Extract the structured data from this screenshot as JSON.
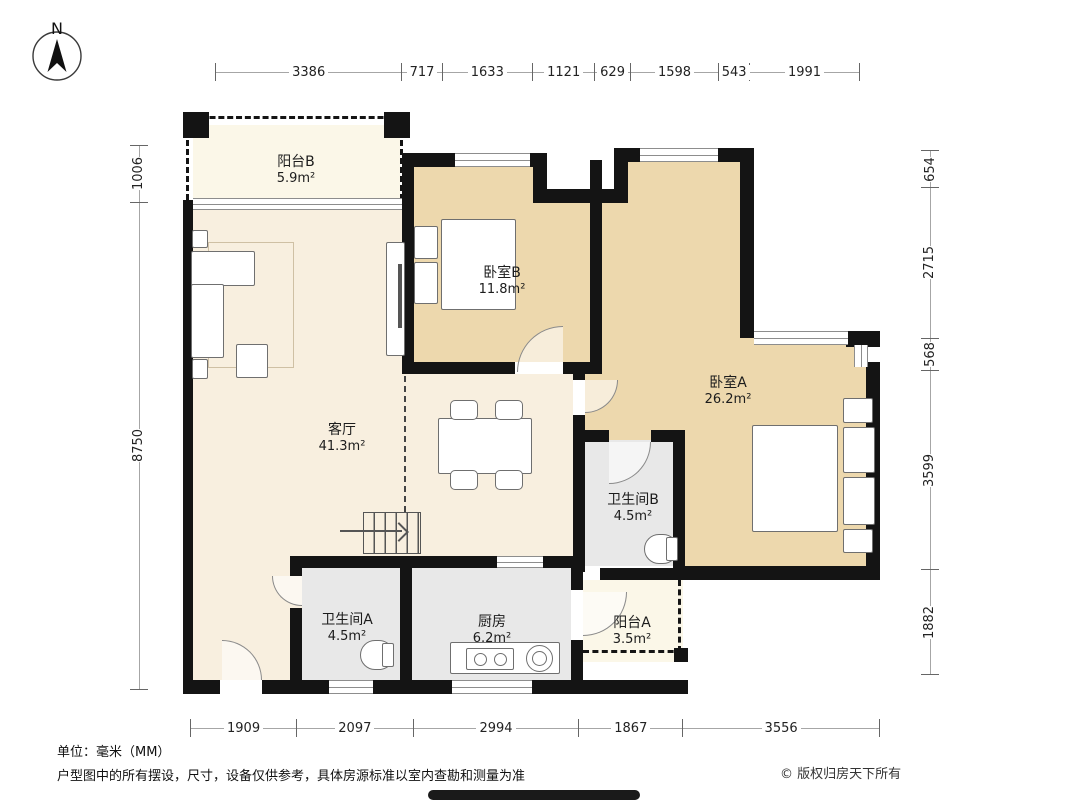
{
  "compass": {
    "label": "N"
  },
  "dimensions": {
    "top": [
      3386,
      717,
      1633,
      1121,
      629,
      1598,
      543,
      1991
    ],
    "bottom": [
      1909,
      2097,
      2994,
      1867,
      3556
    ],
    "left": [
      1006,
      8750
    ],
    "right": [
      654,
      2715,
      568,
      3599,
      1882
    ]
  },
  "rooms": [
    {
      "name": "阳台B",
      "area": "5.9m²"
    },
    {
      "name": "卧室B",
      "area": "11.8m²"
    },
    {
      "name": "卧室A",
      "area": "26.2m²"
    },
    {
      "name": "客厅",
      "area": "41.3m²"
    },
    {
      "name": "卫生间B",
      "area": "4.5m²"
    },
    {
      "name": "卫生间A",
      "area": "4.5m²"
    },
    {
      "name": "厨房",
      "area": "6.2m²"
    },
    {
      "name": "阳台A",
      "area": "3.5m²"
    }
  ],
  "footer": {
    "unit_note": "单位：毫米（MM）",
    "disclaimer": "户型图中的所有摆设，尺寸，设备仅供参考，具体房源标准以室内查勘和测量为准",
    "copyright": "© 版权归房天下所有"
  },
  "colors": {
    "wall": "#141414",
    "bedroom-floor": "#edd8ad",
    "living-floor": "#f8efdf",
    "balcony-floor": "#fbf7e8",
    "service-floor": "#e8e8e8",
    "dim-line": "#9a9a9a",
    "text": "#1c1c1c"
  }
}
